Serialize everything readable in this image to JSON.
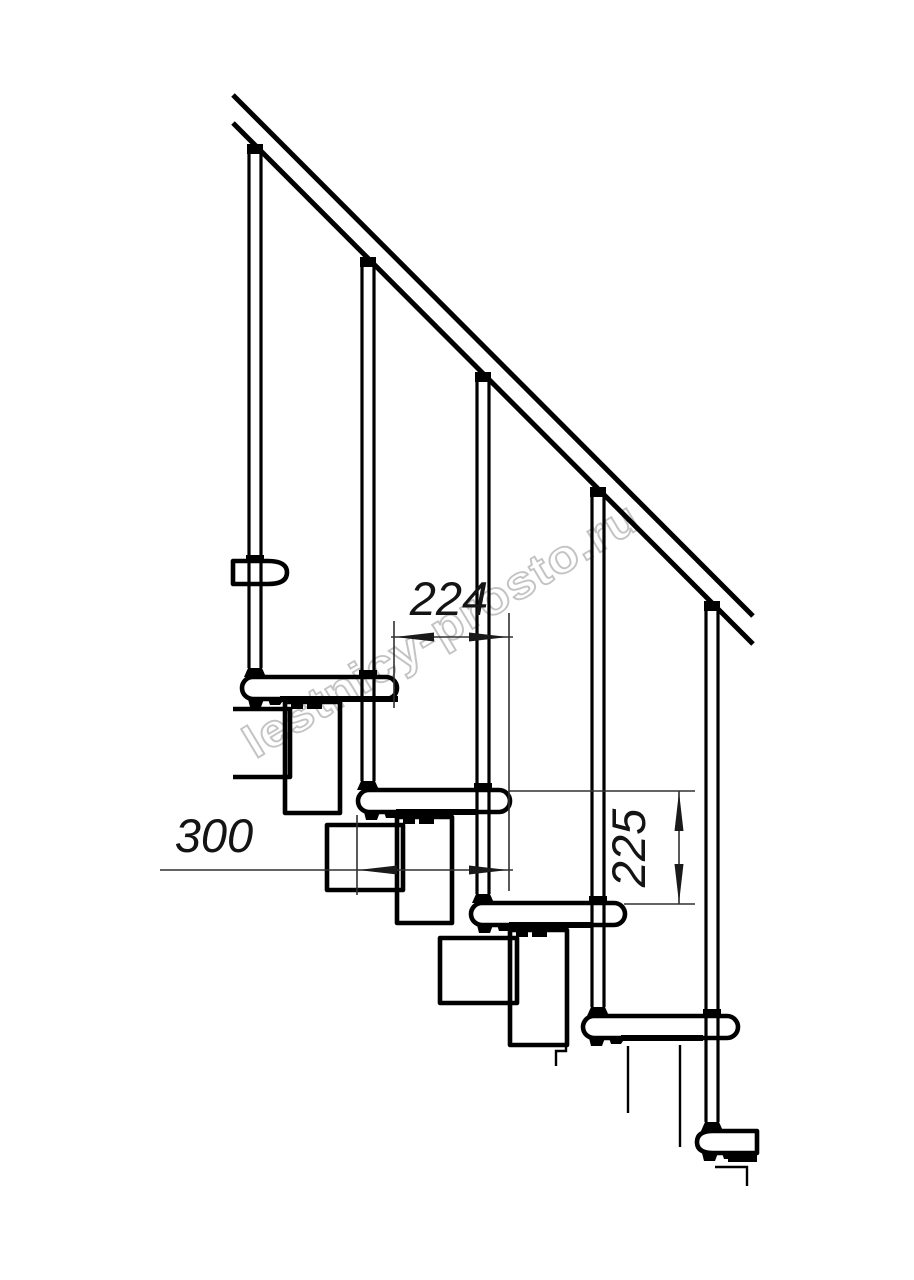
{
  "watermark": {
    "text": "lestnicy-prosto.ru",
    "color": "#a9a9a9"
  },
  "dimensions": {
    "step_run": {
      "value": "224",
      "orientation": "horizontal"
    },
    "tread_depth": {
      "value": "300",
      "orientation": "horizontal"
    },
    "riser_height": {
      "value": "225",
      "orientation": "vertical"
    }
  },
  "colors": {
    "background": "#ffffff",
    "line": "#000000",
    "dimension_line": "#303030"
  }
}
